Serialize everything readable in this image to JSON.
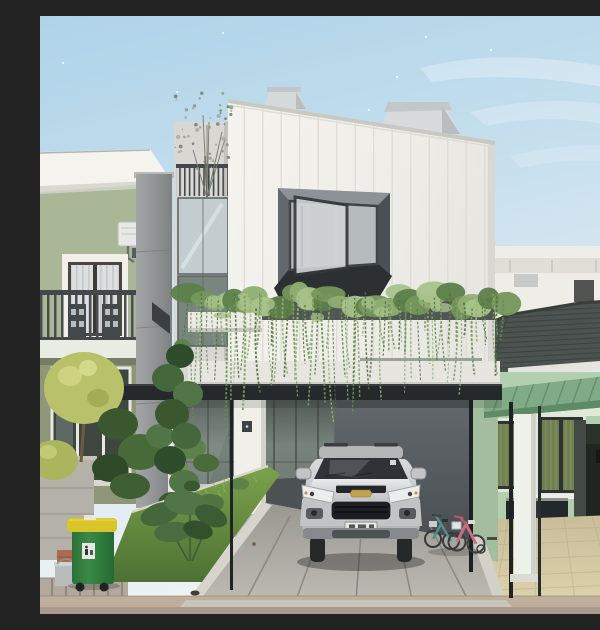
{
  "meta": {
    "alt": "Street-level photograph of a modern three-storey house with a white vertical-panel facade, an open boxed bay window, a curtain of hanging vines across the second floor, a dark flat carport canopy, and a silver Chevrolet SUV parked on a concrete driveway. A sage-green two-storey neighbour house with a balcony stands on the left, a mint-green single-storey house with a dark tiled roof and green pergola on the right. Foreground shows a garden mound with shrubs, a yellow-lidded green wheelie bin, a grass berm, and two small children's bikes.",
    "scene_type": "photograph",
    "objects": [
      "main-house",
      "bay-window",
      "hanging-vines",
      "carport-canopy",
      "suv",
      "left-neighbor-house",
      "right-neighbor-house",
      "trash-bin",
      "kids-bikes",
      "driveway",
      "garden",
      "street",
      "roof-terrace-tree",
      "cat"
    ]
  },
  "palette": {
    "sky_top": "#b3d6e9",
    "sky_mid": "#cde3ef",
    "sky_low": "#e9f1f4",
    "facade_white": "#f1f0eb",
    "facade_seam": "#dcdbd5",
    "tower_wall": "#d8d7d3",
    "chimney": "#d6d8d9",
    "box_face": "#62686c",
    "box_sill": "#2c3033",
    "frame_dark": "#3c4044",
    "sage_wall": "#aab797",
    "olive_wall": "#8e9579",
    "eave_white": "#f4f3ee",
    "rail_dark": "#4a4d50",
    "column_gray": "#97999b",
    "mint_wall": "#b2d0b0",
    "roof_dark": "#4d5350",
    "roof_back": "#9c9c98",
    "pergola_green": "#7da883",
    "door_dark": "#20261f",
    "tile_floor": "#d3c8a2",
    "canopy_dark": "#26292c",
    "glass_wall": "#6b756f",
    "dark_wall": "#575c60",
    "concrete": "#a9a8a2",
    "curb_white": "#d7d4cb",
    "street": "#bfae9c",
    "grass": "#5f8040",
    "leaf_dark": "#33502c",
    "leaf_mid": "#4a6b3a",
    "leaf_light": "#6c8f54",
    "leaf_yellow": "#b9c16b",
    "vine_greens": [
      "#5d7f4a",
      "#75975c",
      "#8fae73",
      "#a9c28a"
    ],
    "strand_greens": [
      "#4f7040",
      "#688a51",
      "#7fa066",
      "#93b377"
    ],
    "bin_green": "#2f7c3c",
    "bin_lid": "#d9c42a",
    "car_body": "#c9cacc",
    "car_glass": "#2f3337",
    "bowtie_gold": "#c2a250",
    "teal_bike": "#4f8f8a",
    "pink_bike": "#c86f7e"
  },
  "scene": {
    "sky_specks": [
      [
        183,
        17
      ],
      [
        357,
        61
      ],
      [
        306,
        151
      ],
      [
        262,
        129
      ],
      [
        137,
        76
      ],
      [
        96,
        258
      ],
      [
        204,
        103
      ],
      [
        23,
        47
      ],
      [
        451,
        34
      ],
      [
        386,
        21
      ],
      [
        329,
        94
      ],
      [
        80,
        160
      ]
    ],
    "vines": {
      "count": 78,
      "clump_count": 30,
      "x_min": 148,
      "x_max": 468,
      "top_min": 276,
      "top_max": 298,
      "len_min": 28,
      "len_max": 92,
      "left_extra": 62
    },
    "tree": {
      "cx": 164,
      "cy": 116,
      "spread_x": 58,
      "spread_y": 86,
      "count": 46,
      "colors": [
        "#8e9788",
        "#a5ad9c",
        "#747d6e"
      ]
    },
    "grass_blades": {
      "count": 16
    }
  }
}
